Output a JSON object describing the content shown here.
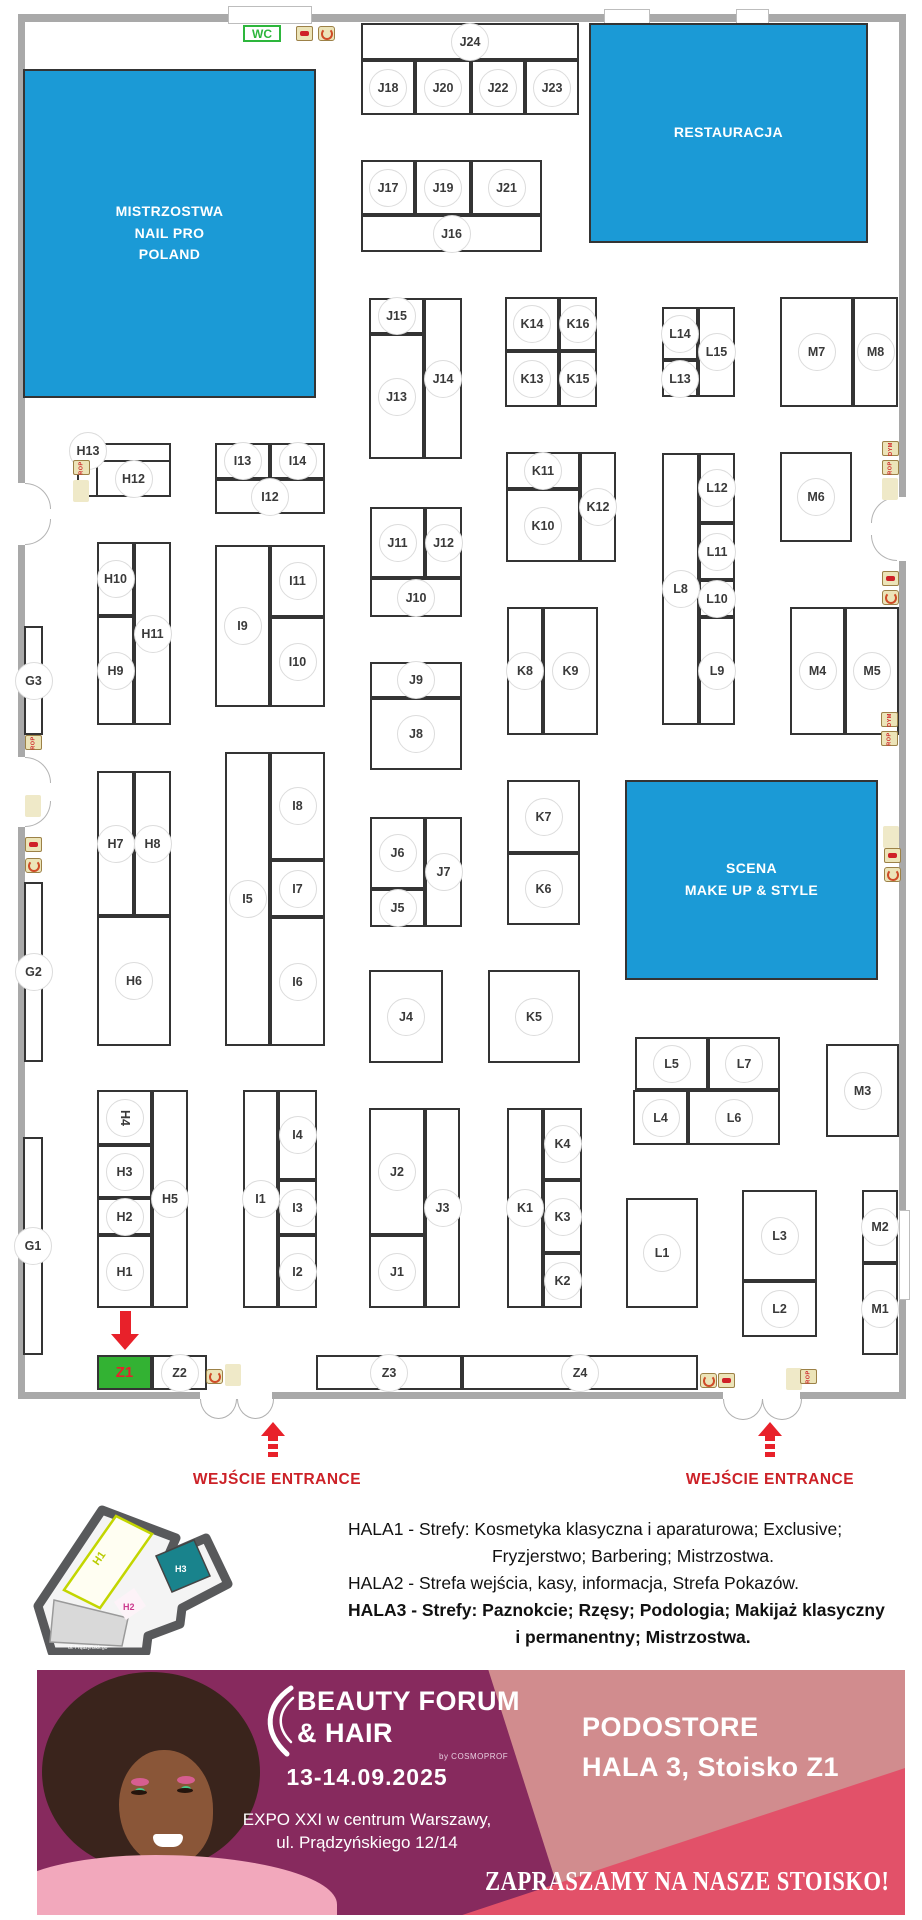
{
  "colors": {
    "zone_blue": "#1b9ad6",
    "booth_green": "#33b233",
    "arrow_red": "#e8212a",
    "entrance_red": "#cc2127",
    "banner_magenta": "#872a5e",
    "banner_salmon": "#d18c8e",
    "banner_coral": "#e25169",
    "wc_green": "#2db63c"
  },
  "plan": {
    "wc_label": "WC",
    "zones": [
      {
        "id": "mistrzostwa-nail-pro",
        "lines": [
          "MISTRZOSTWA",
          "NAIL PRO",
          "POLAND"
        ],
        "x": 23,
        "y": 69,
        "w": 293,
        "h": 329
      },
      {
        "id": "restauracja",
        "lines": [
          "RESTAURACJA"
        ],
        "x": 589,
        "y": 23,
        "w": 279,
        "h": 220
      },
      {
        "id": "scena-makeup",
        "lines": [
          "SCENA",
          "MAKE UP & STYLE"
        ],
        "x": 625,
        "y": 780,
        "w": 253,
        "h": 200
      }
    ],
    "booths": [
      {
        "l": "J24",
        "x": 361,
        "y": 23,
        "w": 218,
        "h": 37
      },
      {
        "l": "J18",
        "x": 361,
        "y": 60,
        "w": 54,
        "h": 55
      },
      {
        "l": "J20",
        "x": 415,
        "y": 60,
        "w": 56,
        "h": 55
      },
      {
        "l": "J22",
        "x": 471,
        "y": 60,
        "w": 54,
        "h": 55
      },
      {
        "l": "J23",
        "x": 525,
        "y": 60,
        "w": 54,
        "h": 55
      },
      {
        "l": "J17",
        "x": 361,
        "y": 160,
        "w": 54,
        "h": 55
      },
      {
        "l": "J19",
        "x": 415,
        "y": 160,
        "w": 56,
        "h": 55
      },
      {
        "l": "J21",
        "x": 471,
        "y": 160,
        "w": 71,
        "h": 55
      },
      {
        "l": "J16",
        "x": 361,
        "y": 215,
        "w": 181,
        "h": 37
      },
      {
        "l": "J15",
        "x": 369,
        "y": 298,
        "w": 55,
        "h": 36
      },
      {
        "l": "J13",
        "x": 369,
        "y": 334,
        "w": 55,
        "h": 125
      },
      {
        "l": "J14",
        "x": 424,
        "y": 298,
        "w": 38,
        "h": 161
      },
      {
        "l": "J11",
        "x": 370,
        "y": 507,
        "w": 55,
        "h": 71
      },
      {
        "l": "J12",
        "x": 425,
        "y": 507,
        "w": 37,
        "h": 71
      },
      {
        "l": "J10",
        "x": 370,
        "y": 578,
        "w": 92,
        "h": 39
      },
      {
        "l": "J9",
        "x": 370,
        "y": 662,
        "w": 92,
        "h": 36
      },
      {
        "l": "J8",
        "x": 370,
        "y": 698,
        "w": 92,
        "h": 72
      },
      {
        "l": "J6",
        "x": 370,
        "y": 817,
        "w": 55,
        "h": 72
      },
      {
        "l": "J5",
        "x": 370,
        "y": 889,
        "w": 55,
        "h": 38
      },
      {
        "l": "J7",
        "x": 425,
        "y": 817,
        "w": 37,
        "h": 110
      },
      {
        "l": "J4",
        "x": 369,
        "y": 970,
        "w": 74,
        "h": 93
      },
      {
        "l": "J2",
        "x": 369,
        "y": 1108,
        "w": 56,
        "h": 127
      },
      {
        "l": "J1",
        "x": 369,
        "y": 1235,
        "w": 56,
        "h": 73
      },
      {
        "l": "J3",
        "x": 425,
        "y": 1108,
        "w": 35,
        "h": 200
      },
      {
        "l": "K14",
        "x": 505,
        "y": 297,
        "w": 54,
        "h": 54
      },
      {
        "l": "K16",
        "x": 559,
        "y": 297,
        "w": 38,
        "h": 54
      },
      {
        "l": "K13",
        "x": 505,
        "y": 351,
        "w": 54,
        "h": 56
      },
      {
        "l": "K15",
        "x": 559,
        "y": 351,
        "w": 38,
        "h": 56
      },
      {
        "l": "K11",
        "x": 506,
        "y": 452,
        "w": 74,
        "h": 37
      },
      {
        "l": "K10",
        "x": 506,
        "y": 489,
        "w": 74,
        "h": 73
      },
      {
        "l": "K12",
        "x": 580,
        "y": 452,
        "w": 36,
        "h": 110
      },
      {
        "l": "K8",
        "x": 507,
        "y": 607,
        "w": 36,
        "h": 128
      },
      {
        "l": "K9",
        "x": 543,
        "y": 607,
        "w": 55,
        "h": 128
      },
      {
        "l": "K7",
        "x": 507,
        "y": 780,
        "w": 73,
        "h": 73
      },
      {
        "l": "K6",
        "x": 507,
        "y": 853,
        "w": 73,
        "h": 72
      },
      {
        "l": "K5",
        "x": 488,
        "y": 970,
        "w": 92,
        "h": 93
      },
      {
        "l": "K1",
        "x": 507,
        "y": 1108,
        "w": 36,
        "h": 200
      },
      {
        "l": "K4",
        "x": 543,
        "y": 1108,
        "w": 39,
        "h": 72
      },
      {
        "l": "K3",
        "x": 543,
        "y": 1180,
        "w": 39,
        "h": 73
      },
      {
        "l": "K2",
        "x": 543,
        "y": 1253,
        "w": 39,
        "h": 55
      },
      {
        "l": "L14",
        "x": 662,
        "y": 307,
        "w": 36,
        "h": 53
      },
      {
        "l": "L13",
        "x": 662,
        "y": 360,
        "w": 36,
        "h": 37
      },
      {
        "l": "L15",
        "x": 698,
        "y": 307,
        "w": 37,
        "h": 90
      },
      {
        "l": "L8",
        "x": 662,
        "y": 453,
        "w": 37,
        "h": 272
      },
      {
        "l": "L12",
        "x": 699,
        "y": 453,
        "w": 36,
        "h": 70
      },
      {
        "l": "L11",
        "x": 699,
        "y": 523,
        "w": 36,
        "h": 57
      },
      {
        "l": "L10",
        "x": 699,
        "y": 580,
        "w": 36,
        "h": 37
      },
      {
        "l": "L9",
        "x": 699,
        "y": 617,
        "w": 36,
        "h": 108
      },
      {
        "l": "L5",
        "x": 635,
        "y": 1037,
        "w": 73,
        "h": 53
      },
      {
        "l": "L7",
        "x": 708,
        "y": 1037,
        "w": 72,
        "h": 53
      },
      {
        "l": "L4",
        "x": 633,
        "y": 1090,
        "w": 55,
        "h": 55
      },
      {
        "l": "L6",
        "x": 688,
        "y": 1090,
        "w": 92,
        "h": 55
      },
      {
        "l": "L1",
        "x": 626,
        "y": 1198,
        "w": 72,
        "h": 110
      },
      {
        "l": "L3",
        "x": 742,
        "y": 1190,
        "w": 75,
        "h": 91
      },
      {
        "l": "L2",
        "x": 742,
        "y": 1281,
        "w": 75,
        "h": 56
      },
      {
        "l": "M7",
        "x": 780,
        "y": 297,
        "w": 73,
        "h": 110
      },
      {
        "l": "M8",
        "x": 853,
        "y": 297,
        "w": 45,
        "h": 110
      },
      {
        "l": "M6",
        "x": 780,
        "y": 452,
        "w": 72,
        "h": 90
      },
      {
        "l": "M4",
        "x": 790,
        "y": 607,
        "w": 55,
        "h": 128
      },
      {
        "l": "M5",
        "x": 845,
        "y": 607,
        "w": 54,
        "h": 128
      },
      {
        "l": "M3",
        "x": 826,
        "y": 1044,
        "w": 73,
        "h": 93
      },
      {
        "l": "M2",
        "x": 862,
        "y": 1190,
        "w": 36,
        "h": 73
      },
      {
        "l": "M1",
        "x": 862,
        "y": 1263,
        "w": 36,
        "h": 92
      },
      {
        "l": "H13",
        "x": 77,
        "y": 443,
        "w": 94,
        "h": 54,
        "lx": 88,
        "ly": 451
      },
      {
        "l": "H12",
        "x": 96,
        "y": 460,
        "w": 75,
        "h": 37
      },
      {
        "l": "H10",
        "x": 97,
        "y": 542,
        "w": 37,
        "h": 74
      },
      {
        "l": "H9",
        "x": 97,
        "y": 616,
        "w": 37,
        "h": 109
      },
      {
        "l": "H11",
        "x": 134,
        "y": 542,
        "w": 37,
        "h": 183
      },
      {
        "l": "H7",
        "x": 97,
        "y": 771,
        "w": 37,
        "h": 145
      },
      {
        "l": "H8",
        "x": 134,
        "y": 771,
        "w": 37,
        "h": 145
      },
      {
        "l": "H6",
        "x": 97,
        "y": 916,
        "w": 74,
        "h": 130
      },
      {
        "l": "H4",
        "x": 97,
        "y": 1090,
        "w": 55,
        "h": 55,
        "rot": 90
      },
      {
        "l": "H3",
        "x": 97,
        "y": 1145,
        "w": 55,
        "h": 53
      },
      {
        "l": "H2",
        "x": 97,
        "y": 1198,
        "w": 55,
        "h": 37
      },
      {
        "l": "H1",
        "x": 97,
        "y": 1235,
        "w": 55,
        "h": 73
      },
      {
        "l": "H5",
        "x": 152,
        "y": 1090,
        "w": 36,
        "h": 218
      },
      {
        "l": "I13",
        "x": 215,
        "y": 443,
        "w": 55,
        "h": 36
      },
      {
        "l": "I14",
        "x": 270,
        "y": 443,
        "w": 55,
        "h": 36
      },
      {
        "l": "I12",
        "x": 215,
        "y": 479,
        "w": 110,
        "h": 35
      },
      {
        "l": "I9",
        "x": 215,
        "y": 545,
        "w": 55,
        "h": 162
      },
      {
        "l": "I11",
        "x": 270,
        "y": 545,
        "w": 55,
        "h": 72
      },
      {
        "l": "I10",
        "x": 270,
        "y": 617,
        "w": 55,
        "h": 90
      },
      {
        "l": "I5",
        "x": 225,
        "y": 752,
        "w": 45,
        "h": 294
      },
      {
        "l": "I8",
        "x": 270,
        "y": 752,
        "w": 55,
        "h": 108
      },
      {
        "l": "I7",
        "x": 270,
        "y": 860,
        "w": 55,
        "h": 57
      },
      {
        "l": "I6",
        "x": 270,
        "y": 917,
        "w": 55,
        "h": 129
      },
      {
        "l": "I1",
        "x": 243,
        "y": 1090,
        "w": 35,
        "h": 218
      },
      {
        "l": "I4",
        "x": 278,
        "y": 1090,
        "w": 39,
        "h": 90
      },
      {
        "l": "I3",
        "x": 278,
        "y": 1180,
        "w": 39,
        "h": 55
      },
      {
        "l": "I2",
        "x": 278,
        "y": 1235,
        "w": 39,
        "h": 73
      },
      {
        "l": "G3",
        "x": 24,
        "y": 626,
        "w": 19,
        "h": 109
      },
      {
        "l": "G2",
        "x": 24,
        "y": 882,
        "w": 19,
        "h": 180
      },
      {
        "l": "G1",
        "x": 23,
        "y": 1137,
        "w": 20,
        "h": 218
      },
      {
        "l": "Z1",
        "x": 97,
        "y": 1355,
        "w": 55,
        "h": 35,
        "type": "green"
      },
      {
        "l": "Z2",
        "x": 152,
        "y": 1355,
        "w": 55,
        "h": 35
      },
      {
        "l": "Z3",
        "x": 316,
        "y": 1355,
        "w": 146,
        "h": 35
      },
      {
        "l": "Z4",
        "x": 462,
        "y": 1355,
        "w": 236,
        "h": 35
      }
    ],
    "safety_icons": [
      {
        "k": "ext",
        "x": 296,
        "y": 26
      },
      {
        "k": "spiral",
        "x": 318,
        "y": 26
      },
      {
        "k": "rop",
        "x": 73,
        "y": 460,
        "t": "ROP"
      },
      {
        "k": "pad",
        "x": 73,
        "y": 480
      },
      {
        "k": "rop",
        "x": 25,
        "y": 735,
        "t": "ROP"
      },
      {
        "k": "pad",
        "x": 25,
        "y": 795
      },
      {
        "k": "ext",
        "x": 25,
        "y": 837
      },
      {
        "k": "spiral",
        "x": 25,
        "y": 858
      },
      {
        "k": "dym",
        "x": 882,
        "y": 441,
        "t": "DYM"
      },
      {
        "k": "rop",
        "x": 882,
        "y": 460,
        "t": "ROP"
      },
      {
        "k": "pad",
        "x": 882,
        "y": 478
      },
      {
        "k": "ext",
        "x": 882,
        "y": 571
      },
      {
        "k": "spiral",
        "x": 882,
        "y": 590
      },
      {
        "k": "dym",
        "x": 881,
        "y": 712,
        "t": "DYM"
      },
      {
        "k": "rop",
        "x": 881,
        "y": 731,
        "t": "ROP"
      },
      {
        "k": "pad",
        "x": 883,
        "y": 826
      },
      {
        "k": "ext",
        "x": 884,
        "y": 848
      },
      {
        "k": "spiral",
        "x": 884,
        "y": 867
      },
      {
        "k": "spiral",
        "x": 206,
        "y": 1369
      },
      {
        "k": "pad",
        "x": 225,
        "y": 1364
      },
      {
        "k": "spiral",
        "x": 700,
        "y": 1373
      },
      {
        "k": "ext",
        "x": 718,
        "y": 1373
      },
      {
        "k": "pad",
        "x": 786,
        "y": 1368
      },
      {
        "k": "rop",
        "x": 800,
        "y": 1369,
        "t": "ROP"
      }
    ]
  },
  "entrances": {
    "left": {
      "label": "WEJŚCIE ENTRANCE"
    },
    "right": {
      "label": "WEJŚCIE ENTRANCE"
    }
  },
  "legend": {
    "lines": [
      "HALA1 - Strefy: Kosmetyka klasyczna i aparaturowa; Exclusive;",
      "Fryzjerstwo; Barbering; Mistrzostwa.",
      "HALA2 - Strefa wejścia, kasy, informacja, Strefa Pokazów.",
      "HALA3 - Strefy: Paznokcie; Rzęsy; Podologia; Makijaż klasyczny",
      "i permanentny; Mistrzostwa."
    ]
  },
  "minimap": {
    "h1": "H1",
    "h2": "H2",
    "h3": "H3",
    "street": "ul. Prądzyńskiego"
  },
  "banner": {
    "logo_line1": "BEAUTY FORUM",
    "logo_line2": "& HAIR",
    "logo_sub": "by COSMOPROF",
    "date": "13-14.09.2025",
    "venue_line1": "EXPO XXI w centrum Warszawy,",
    "venue_line2": "ul. Prądzyńskiego 12/14",
    "exhibitor": "PODOSTORE",
    "location": "HALA 3, Stoisko Z1",
    "slogan": "ZAPRASZAMY NA NASZE STOISKO!"
  }
}
